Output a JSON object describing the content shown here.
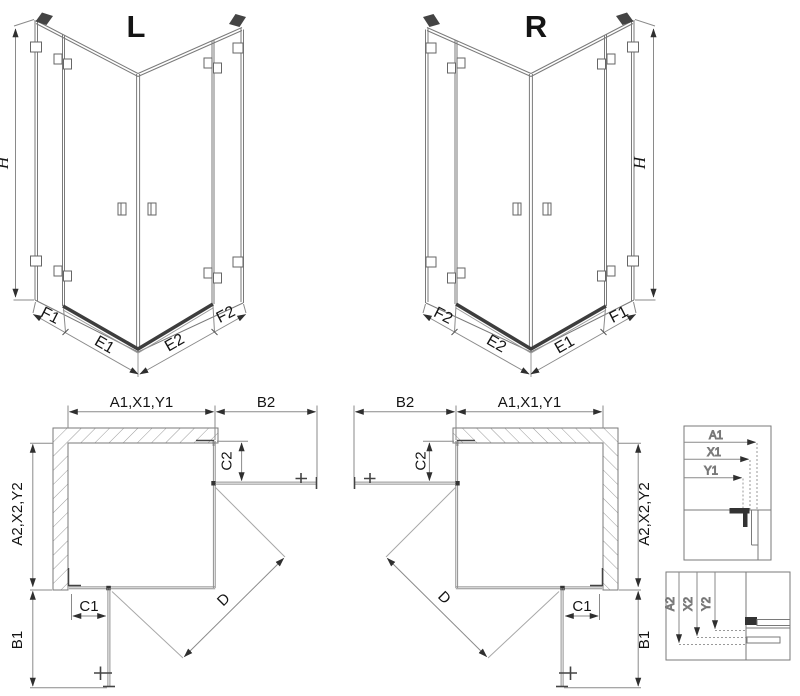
{
  "drawing": {
    "type": "technical-drawing",
    "subject": "corner shower enclosure, left (L) and right (R) versions, isometric views with plan views and measurement detail insets",
    "colors": {
      "line": "#7a7a7a",
      "glass_line": "#8f8f8f",
      "dark_profile": "#333333",
      "text": "#141414",
      "hatch": "#9a9a9a"
    }
  },
  "iso_left": {
    "variant": "L",
    "height": "H",
    "segments": [
      "F1",
      "E1",
      "E2",
      "F2"
    ]
  },
  "iso_right": {
    "variant": "R",
    "height": "H",
    "segments": [
      "F2",
      "E2",
      "E1",
      "F1"
    ]
  },
  "plan_left": {
    "width_top": "A1,X1,Y1",
    "door_top": "B2",
    "offset_top": "C2",
    "depth": "A2,X2,Y2",
    "offset_bottom": "C1",
    "door_bottom": "B1",
    "diagonal": "D"
  },
  "plan_right": {
    "width_top": "A1,X1,Y1",
    "door_top": "B2",
    "offset_top": "C2",
    "depth": "A2,X2,Y2",
    "offset_bottom": "C1",
    "door_bottom": "B1",
    "diagonal": "D"
  },
  "detail_top": {
    "a1": "A1",
    "x1": "X1",
    "y1": "Y1"
  },
  "detail_bottom": {
    "a2": "A2",
    "x2": "X2",
    "y2": "Y2"
  }
}
